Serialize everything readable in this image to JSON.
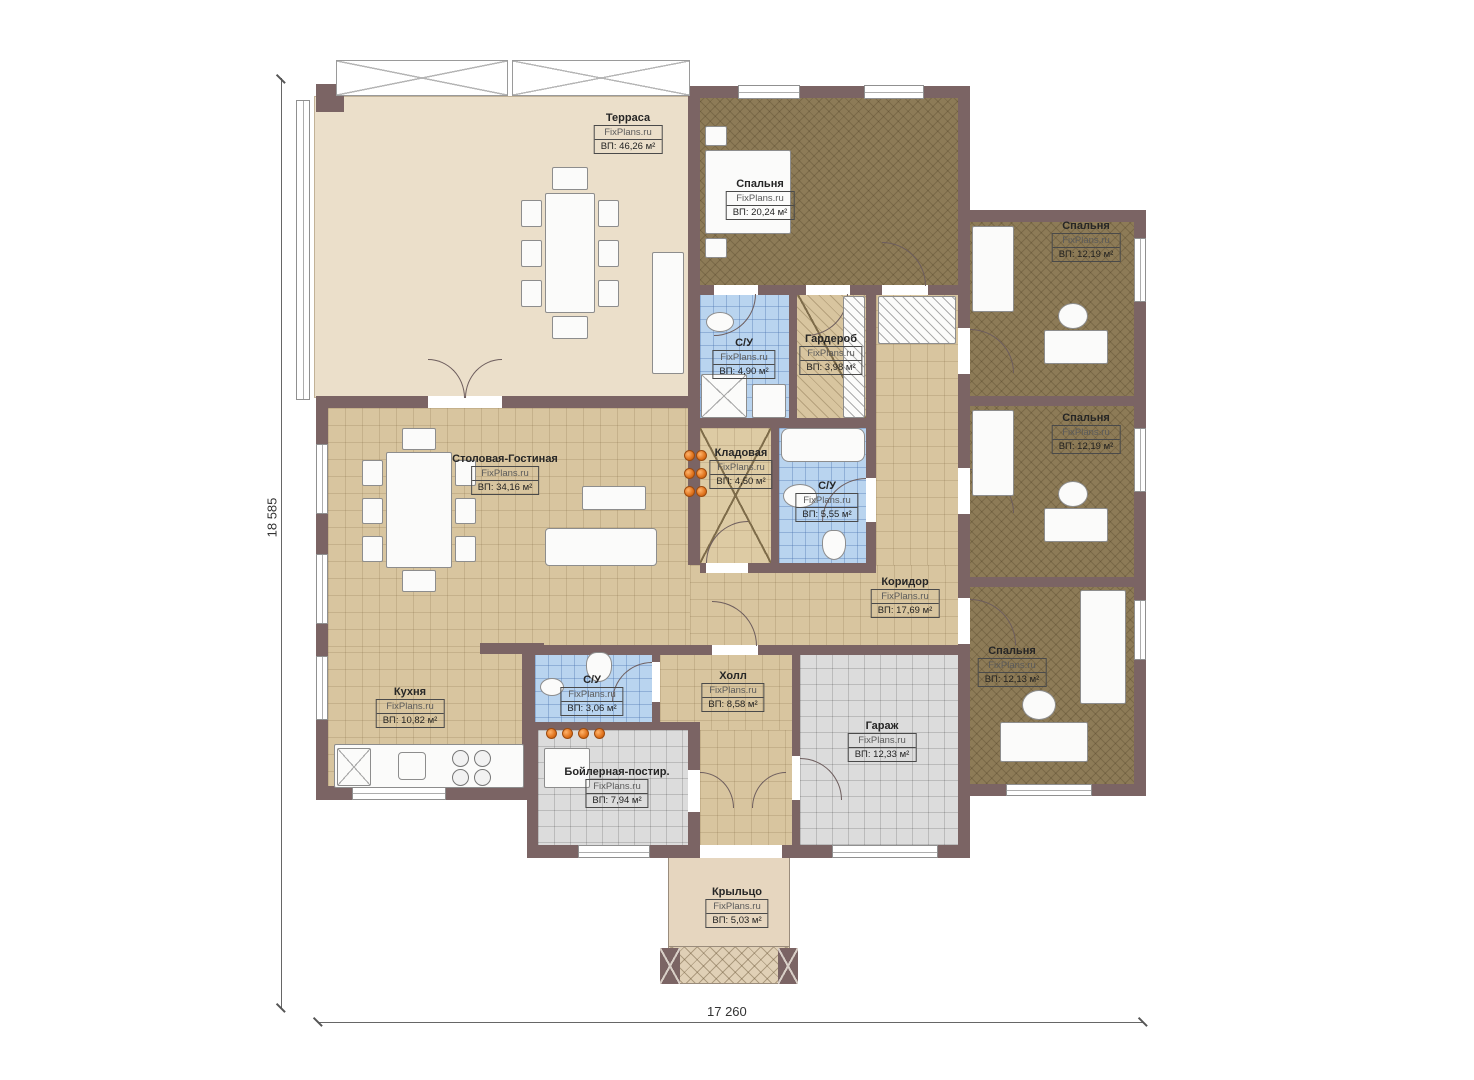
{
  "dimensions": {
    "vertical": "18 585",
    "horizontal": "17 260"
  },
  "rooms": [
    {
      "name": "Терраса",
      "wm": "FixPlans.ru",
      "area": "ВП: 46,26 м²"
    },
    {
      "name": "Спальня",
      "wm": "FixPlans.ru",
      "area": "ВП: 20,24 м²"
    },
    {
      "name": "Спальня",
      "wm": "FixPlans.ru",
      "area": "ВП: 12,19 м²"
    },
    {
      "name": "Спальня",
      "wm": "FixPlans.ru",
      "area": "ВП: 12,19 м²"
    },
    {
      "name": "Спальня",
      "wm": "FixPlans.ru",
      "area": "ВП: 12,13 м²"
    },
    {
      "name": "С/У",
      "wm": "FixPlans.ru",
      "area": "ВП: 4,90 м²"
    },
    {
      "name": "Гардероб",
      "wm": "FixPlans.ru",
      "area": "ВП: 3,98 м²"
    },
    {
      "name": "Кладовая",
      "wm": "FixPlans.ru",
      "area": "ВП: 4,50 м²"
    },
    {
      "name": "С/У",
      "wm": "FixPlans.ru",
      "area": "ВП: 5,55 м²"
    },
    {
      "name": "Столовая-Гостиная",
      "wm": "FixPlans.ru",
      "area": "ВП: 34,16 м²"
    },
    {
      "name": "Коридор",
      "wm": "FixPlans.ru",
      "area": "ВП: 17,69 м²"
    },
    {
      "name": "Кухня",
      "wm": "FixPlans.ru",
      "area": "ВП: 10,82 м²"
    },
    {
      "name": "С/У",
      "wm": "FixPlans.ru",
      "area": "ВП: 3,06 м²"
    },
    {
      "name": "Холл",
      "wm": "FixPlans.ru",
      "area": "ВП: 8,58 м²"
    },
    {
      "name": "Гараж",
      "wm": "FixPlans.ru",
      "area": "ВП: 12,33 м²"
    },
    {
      "name": "Бойлерная-постир.",
      "wm": "FixPlans.ru",
      "area": "ВП: 7,94 м²"
    },
    {
      "name": "Крыльцо",
      "wm": "FixPlans.ru",
      "area": "ВП: 5,03 м²"
    }
  ],
  "colors": {
    "wall": "#7b6464",
    "floor_terrace": "#ebdfca",
    "floor_tile_tan": "#d8c59f",
    "floor_bedroom_brown": "#8d7b57",
    "floor_bath_blue": "#b9d4ef",
    "floor_garage_gray": "#dcdcdc",
    "accent_orange": "#e0731d"
  }
}
